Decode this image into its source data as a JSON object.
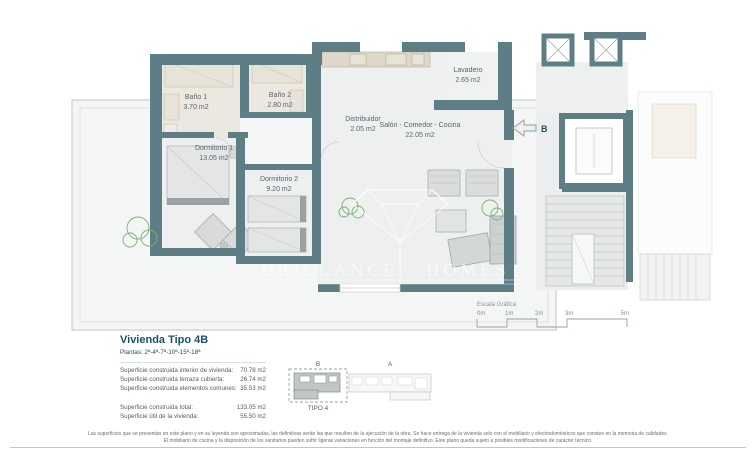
{
  "plan": {
    "rooms": [
      {
        "name": "Baño 1",
        "area": "3.70 m2"
      },
      {
        "name": "Baño 2",
        "area": "2.80 m2"
      },
      {
        "name": "Distribuidor",
        "area": "2.05 m2"
      },
      {
        "name": "Dormitorio 1",
        "area": "13.05 m2"
      },
      {
        "name": "Dormitorio 2",
        "area": "9.20 m2"
      },
      {
        "name": "Salón - Comedor - Cocina",
        "area": "22.05 m2"
      },
      {
        "name": "Lavadero",
        "area": "2.65 m2"
      }
    ],
    "section_marker": "B",
    "watermark": {
      "word1": "BRILLANCE",
      "word2": "HOMES"
    }
  },
  "scale_bar": {
    "title": "Escala Gráfica",
    "ticks": [
      "0m",
      "1m",
      "2m",
      "3m",
      "5m"
    ]
  },
  "info": {
    "title": "Vivienda Tipo 4B",
    "floors": "Plantas: 2ª-4ª-7ª-10ª-15ª-18ª",
    "rows": [
      {
        "label": "Superficie construida interior de vivienda:",
        "value": "70.78 m2"
      },
      {
        "label": "Superficie construida terraza cubierta:",
        "value": "26.74 m2"
      },
      {
        "label": "Superficie construida elementos comunes:",
        "value": "35.53 m2"
      }
    ],
    "totals": [
      {
        "label": "Superficie construida total:",
        "value": "133.05 m2"
      },
      {
        "label": "Superficie útil de la vivienda:",
        "value": "55.50 m2"
      }
    ]
  },
  "key_plan": {
    "block_b": "B",
    "block_a": "A",
    "label": "TIPO 4"
  },
  "disclaimer": {
    "line1": "Las superficies que se presentan en este plano y en su leyenda son aproximadas, las definitivas serán las que resulten de la ejecución de la obra. Se hace entrega de la vivienda solo con el mobiliario y electrodomésticos que consten en la memoria de calidades.",
    "line2": "El mobiliario de cocina y la disposición de los sanitarios pueden sufrir ligeras variaciones en función del montaje definitivo. Este plano queda sujeto a posibles modificaciones de carácter técnico."
  },
  "colors": {
    "wall": "#5e7e85",
    "accent": "#1d5066",
    "plant": "#79b170"
  }
}
